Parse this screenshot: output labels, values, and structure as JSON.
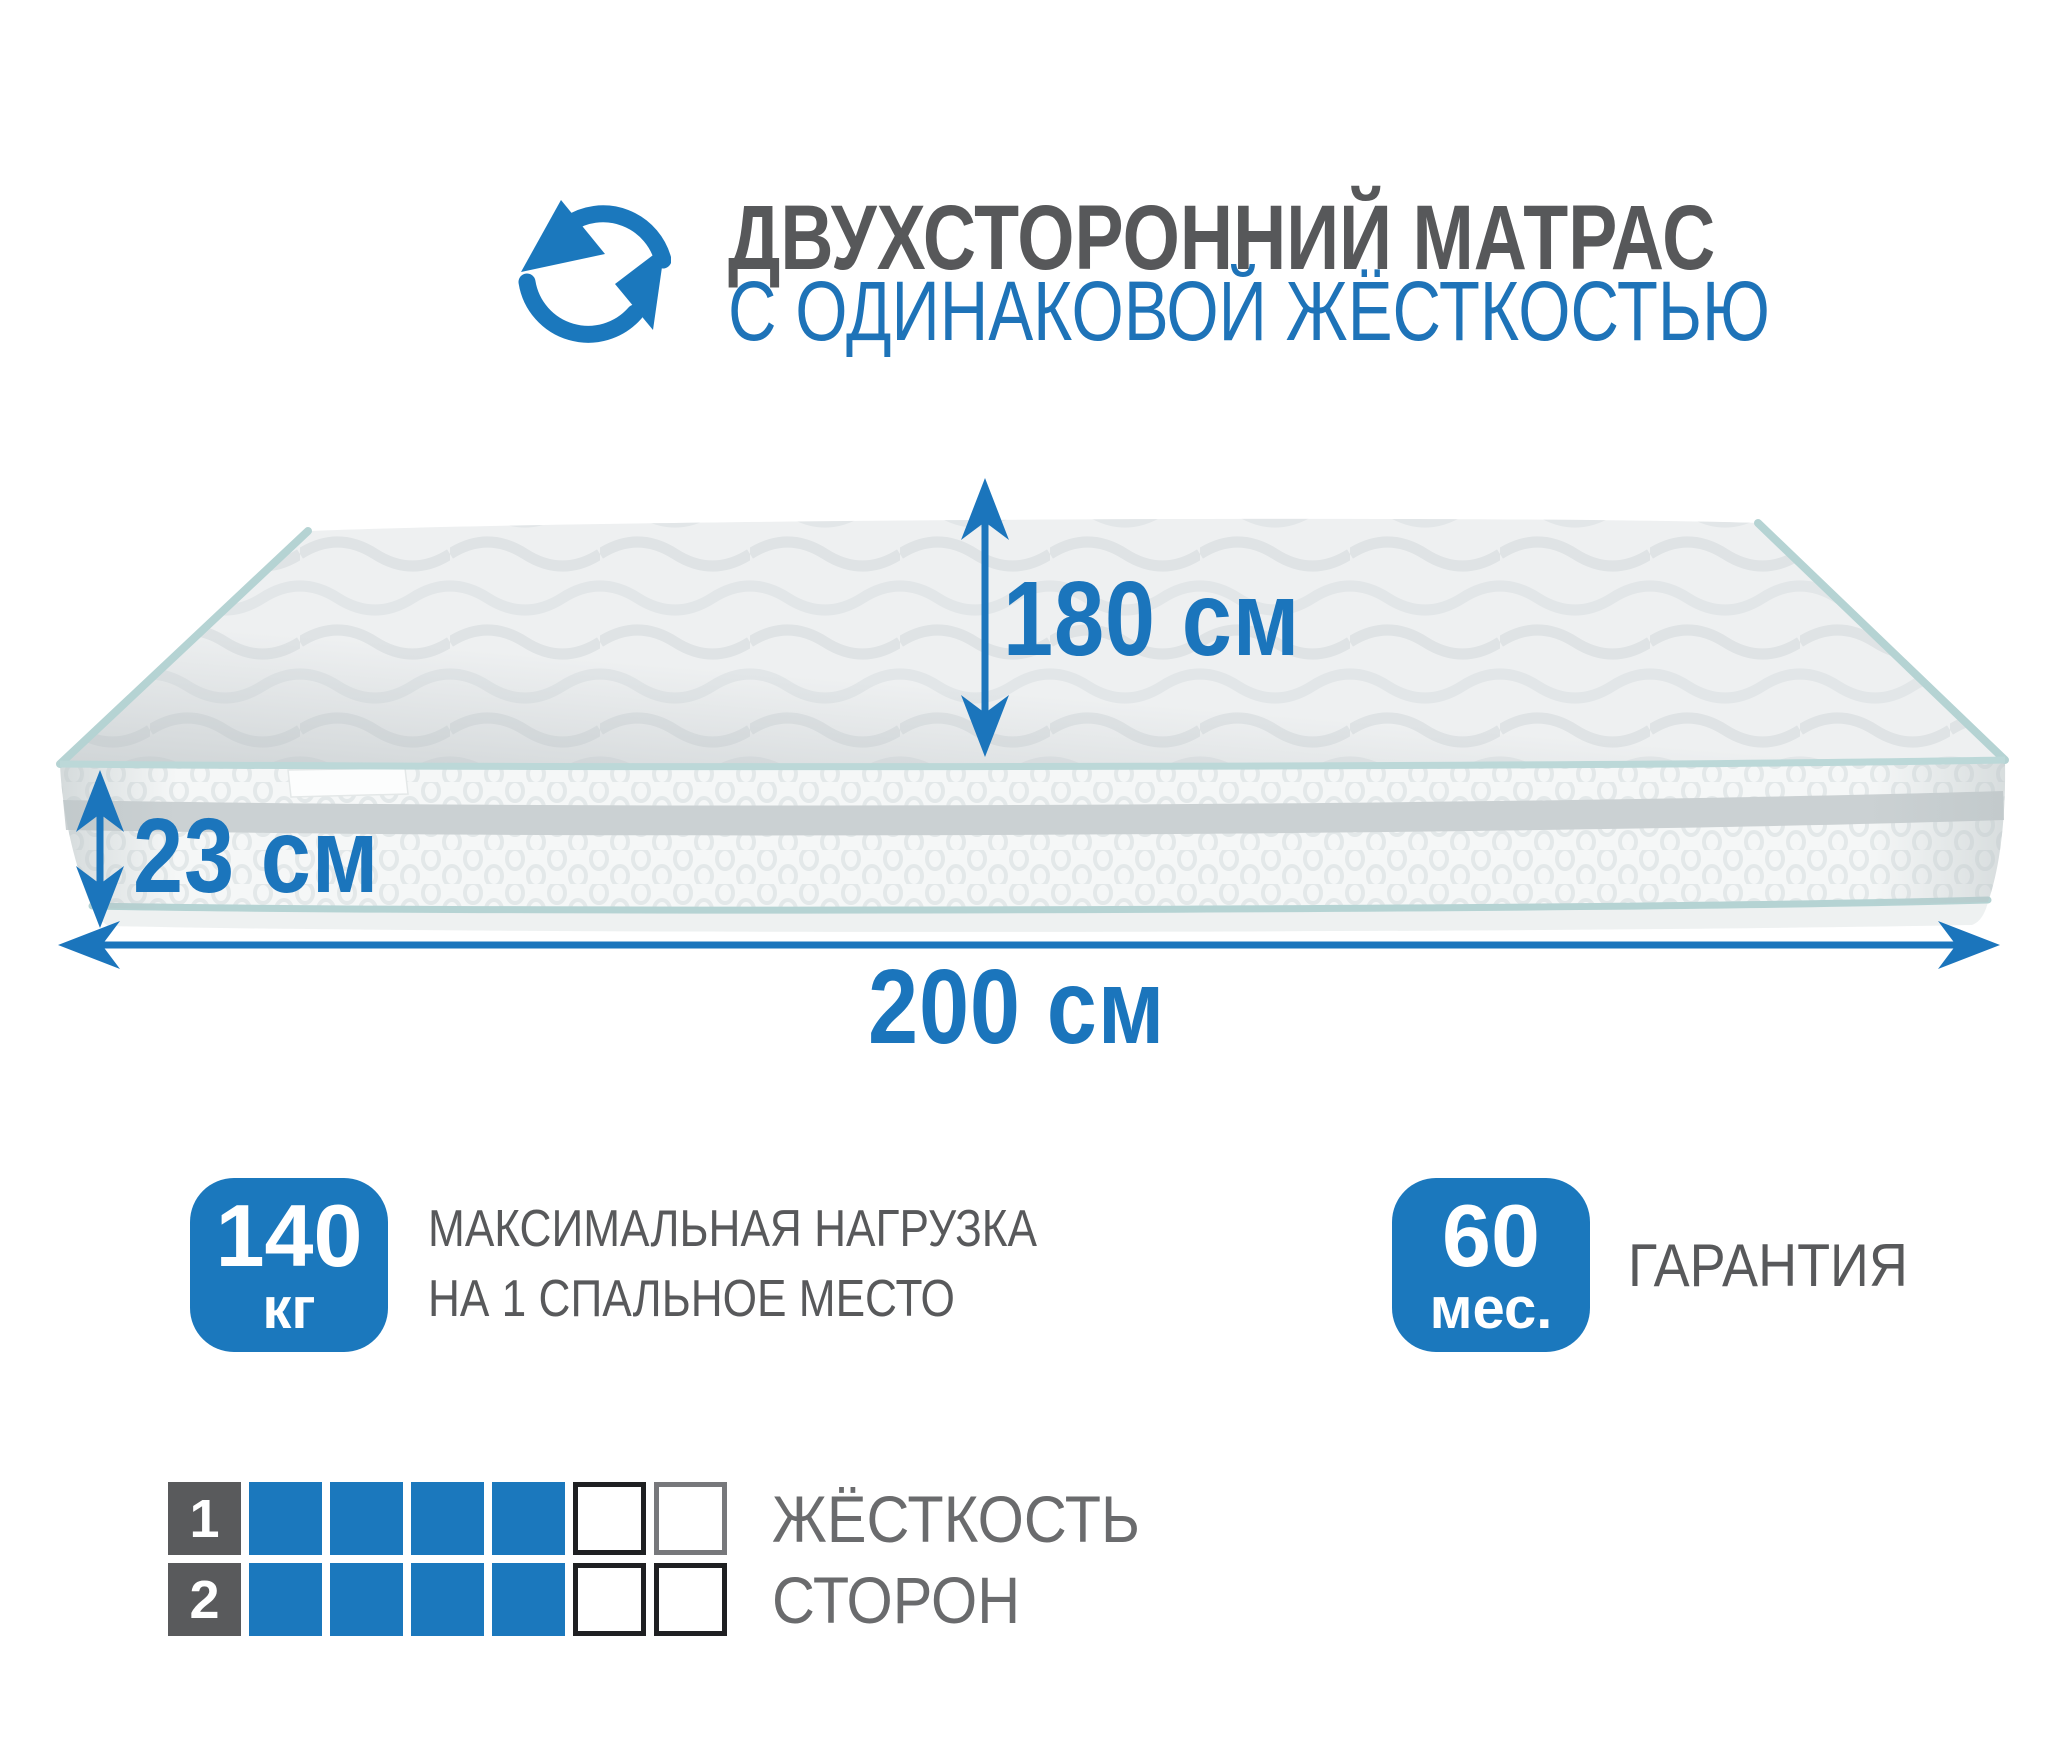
{
  "header": {
    "icon": "rotate-arrows-icon",
    "title": "ДВУХСТОРОННИЙ МАТРАС",
    "subtitle": "С ОДИНАКОВОЙ ЖЁСТКОСТЬЮ"
  },
  "dimensions": {
    "length": {
      "value": "180",
      "unit": "см"
    },
    "height": {
      "value": "23",
      "unit": "см"
    },
    "width": {
      "value": "200",
      "unit": "см"
    }
  },
  "badges": {
    "max_load": {
      "value": "140",
      "unit": "кг",
      "caption_line1": "МАКСИМАЛЬНАЯ НАГРУЗКА",
      "caption_line2": "НА 1 СПАЛЬНОЕ МЕСТО"
    },
    "warranty": {
      "value": "60",
      "unit": "мес.",
      "caption": "ГАРАНТИЯ"
    }
  },
  "firmness_scale": {
    "caption_line1": "ЖЁСТКОСТЬ",
    "caption_line2": "СТОРОН",
    "cells_total": 6,
    "rows": [
      {
        "side": "1",
        "filled_cells": 4
      },
      {
        "side": "2",
        "filled_cells": 4
      }
    ]
  },
  "colors": {
    "accent_blue": "#1b78bd",
    "dimension_blue": "#1b75bc",
    "title_gray": "#57585a",
    "caption_gray": "#6a6b6d",
    "number_box_gray": "#595a5c",
    "piping_teal": "#b5d3d3"
  }
}
